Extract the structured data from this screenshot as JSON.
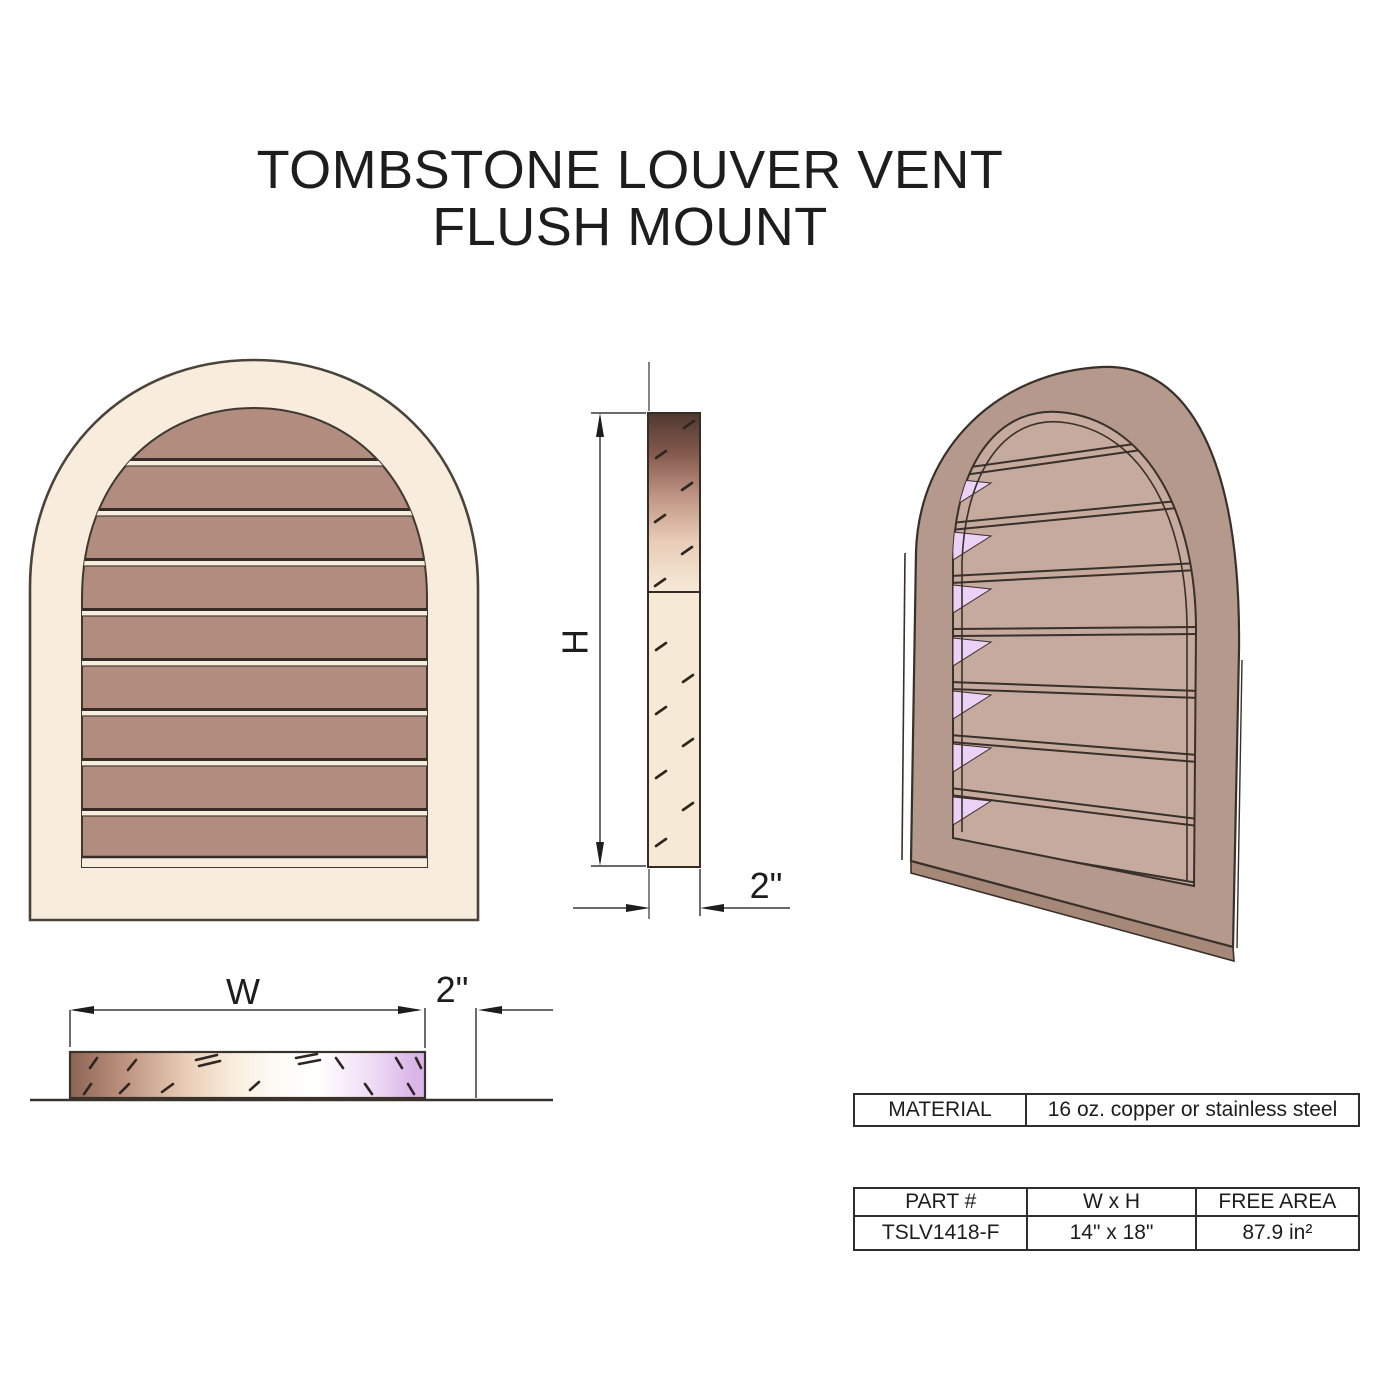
{
  "title": {
    "line1": "TOMBSTONE LOUVER VENT",
    "line2": "FLUSH MOUNT"
  },
  "dimensions": {
    "height": "H",
    "width": "W",
    "side_depth": "2\"",
    "bottom_depth": "2\""
  },
  "material_table": {
    "label": "MATERIAL",
    "value": "16 oz. copper or stainless steel"
  },
  "part_table": {
    "headers": [
      "PART #",
      "W x H",
      "FREE AREA"
    ],
    "row": [
      "TSLV1418-F",
      "14\" x 18\"",
      "87.9 in²"
    ]
  },
  "colors": {
    "frame_cream": "#f8ecdd",
    "louver_mauve": "#b18c7f",
    "outline_dark": "#40392f",
    "perspective_frame": "#b5998c",
    "perspective_slat": "#c6aa9d",
    "perspective_gap_lavender": "#ebd1f5",
    "bottom_bar_lavender": "#dcb9ea",
    "side_gradient_top": "#4f3831"
  }
}
